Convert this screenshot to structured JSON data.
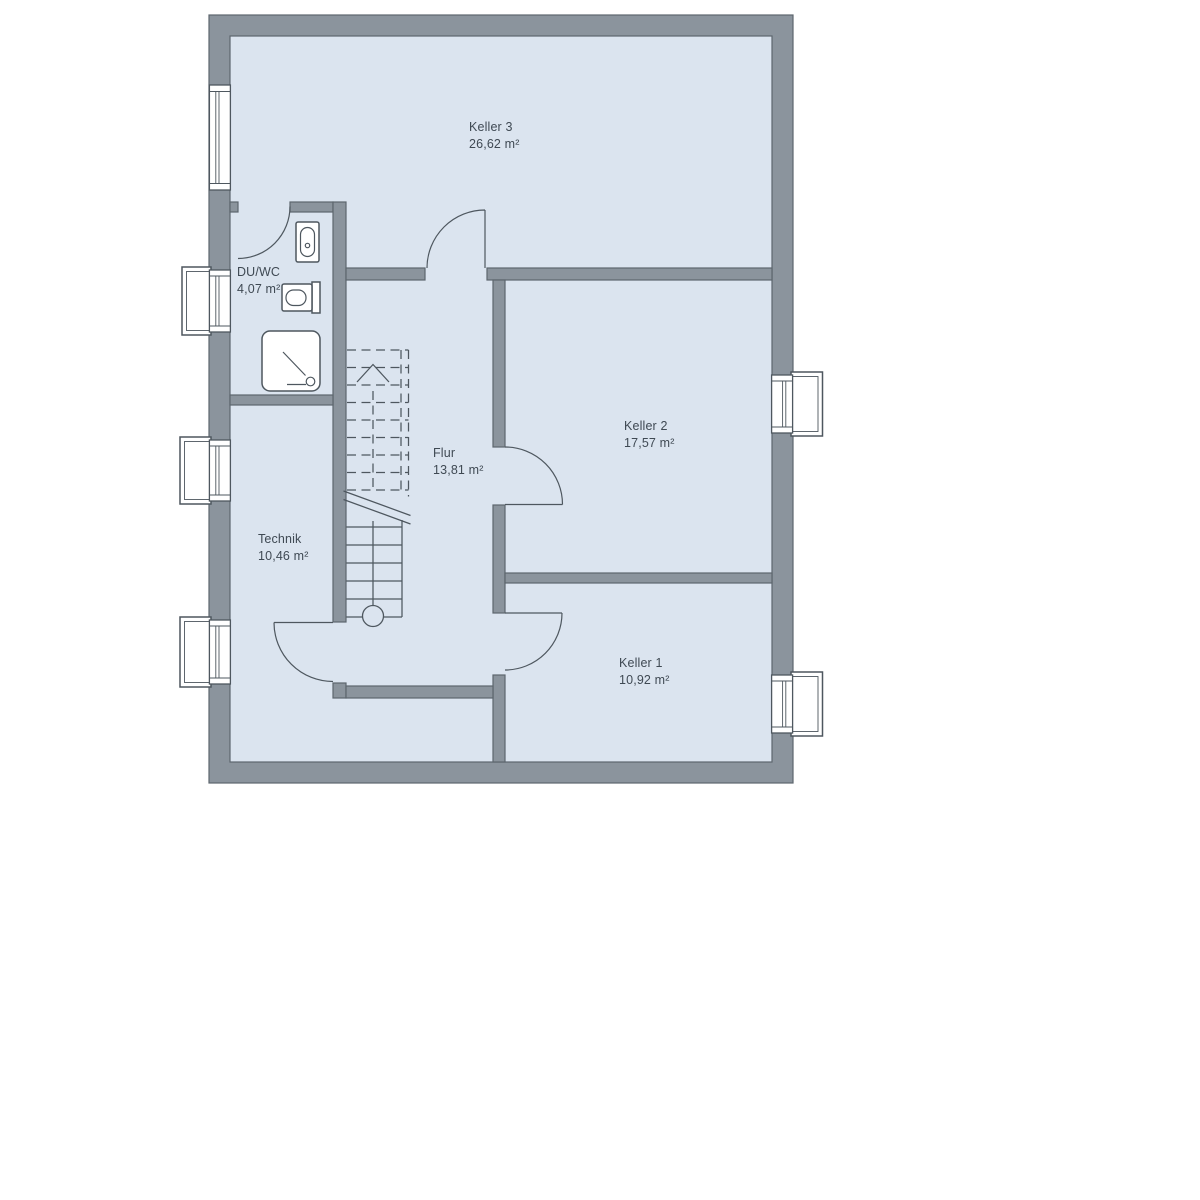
{
  "plan": {
    "type": "floor-plan",
    "floor_label": "basement",
    "rooms": [
      {
        "id": "keller3",
        "name": "Keller 3",
        "area": "26,62 m²"
      },
      {
        "id": "keller2",
        "name": "Keller 2",
        "area": "17,57 m²"
      },
      {
        "id": "keller1",
        "name": "Keller 1",
        "area": "10,92 m²"
      },
      {
        "id": "flur",
        "name": "Flur",
        "area": "13,81 m²"
      },
      {
        "id": "technik",
        "name": "Technik",
        "area": "10,46 m²"
      },
      {
        "id": "duwc",
        "name": "DU/WC",
        "area": "4,07 m²"
      }
    ],
    "features": [
      "staircase",
      "shower",
      "wc",
      "sink",
      "windows-with-light-wells",
      "door-swings"
    ]
  },
  "colors": {
    "floor": "#DBE4EF",
    "wall": "#8B949D",
    "wallEdge": "#5D666E",
    "line": "#4E575F",
    "text": "#3F4953",
    "background": "#FFFFFF"
  }
}
